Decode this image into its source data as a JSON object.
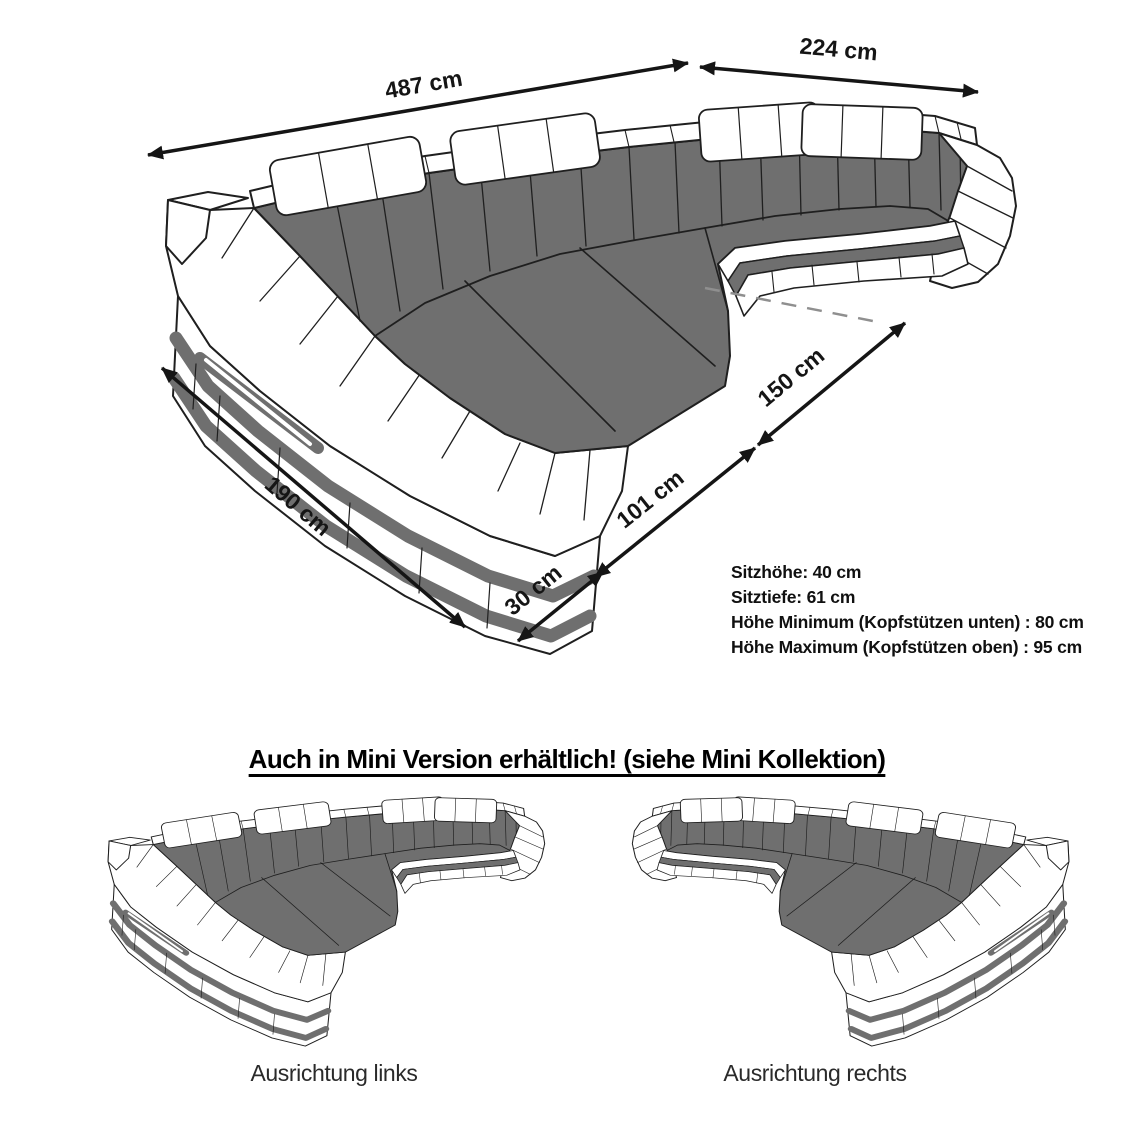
{
  "diagram": {
    "dimensions": {
      "width_total": "487 cm",
      "width_right": "224 cm",
      "depth_right": "150 cm",
      "depth_mid": "101 cm",
      "depth_small": "30 cm",
      "depth_left": "190 cm"
    },
    "specs": [
      "Sitzhöhe: 40 cm",
      "Sitztiefe: 61 cm",
      "Höhe Minimum (Kopfstützen unten) : 80 cm",
      "Höhe Maximum (Kopfstützen oben) : 95 cm"
    ]
  },
  "mini_section": {
    "heading": "Auch in Mini Version erhältlich! (siehe Mini Kollektion)",
    "variants": [
      {
        "label": "Ausrichtung links"
      },
      {
        "label": "Ausrichtung rechts"
      }
    ]
  },
  "colors": {
    "cushion_gray": "#6f6f6f",
    "outline": "#1f1f1f",
    "dashed_gray": "#8f8f8f"
  }
}
